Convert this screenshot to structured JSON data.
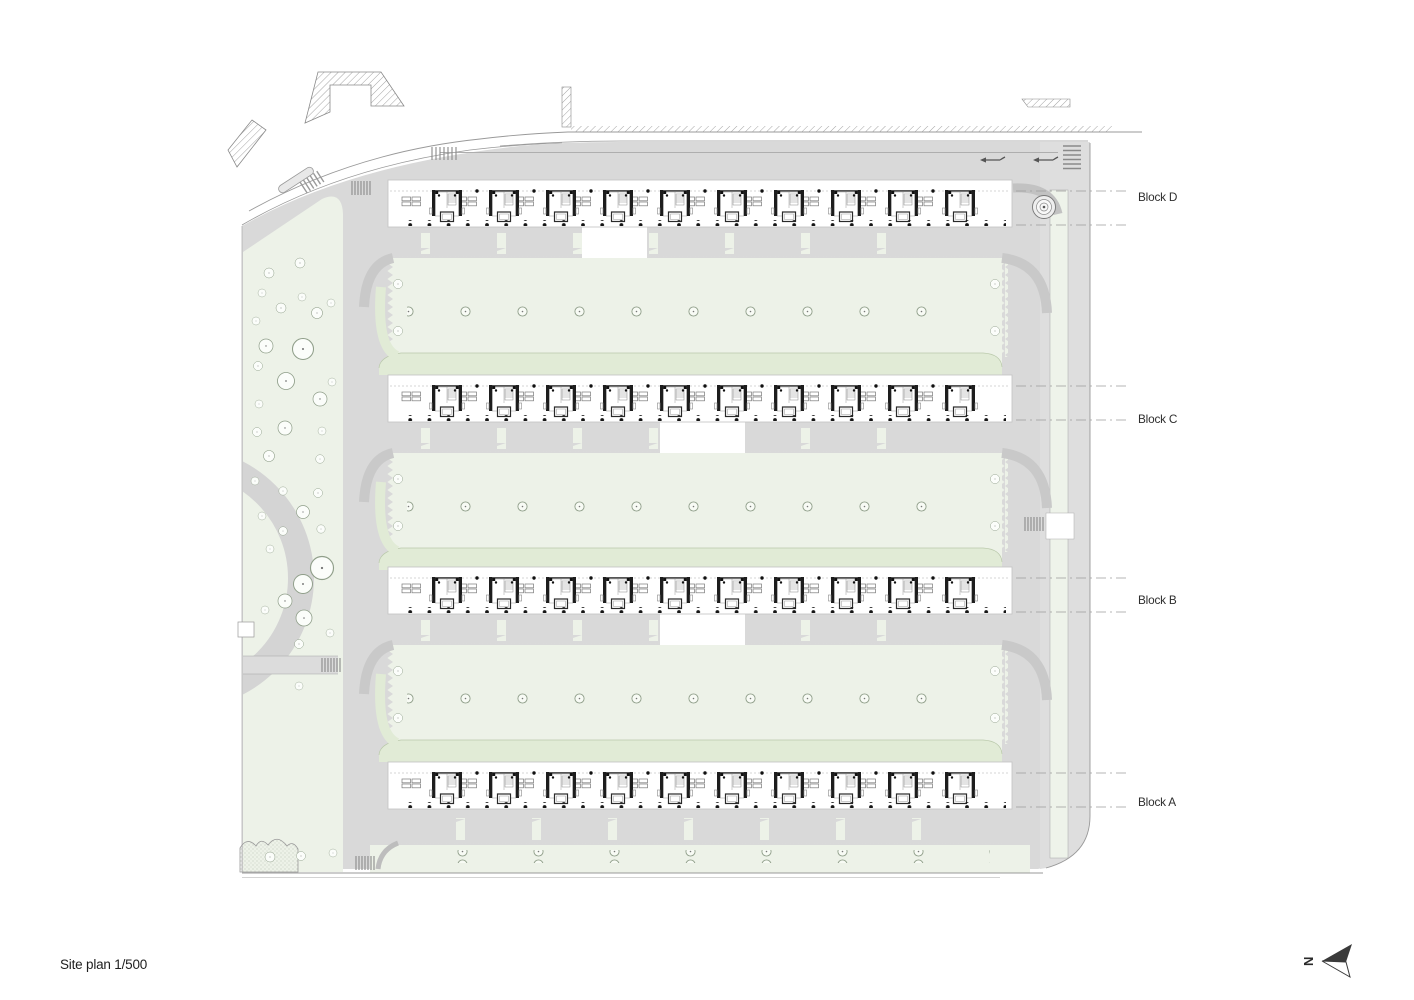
{
  "drawing": {
    "title": "Site plan 1/500",
    "north_label": "N",
    "blocks": [
      {
        "name": "Block D"
      },
      {
        "name": "Block C"
      },
      {
        "name": "Block B"
      },
      {
        "name": "Block A"
      }
    ]
  },
  "colors": {
    "paper": "#ffffff",
    "path_gray": "#d9d9d9",
    "light_gray": "#e4e4e4",
    "dark_path": "#c9c9c9",
    "green_light": "#edf2e8",
    "green_band": "#e1ebd6",
    "green_edge": "#b9c8aa",
    "line_gray": "#999999",
    "ink": "#2e2e2e"
  }
}
